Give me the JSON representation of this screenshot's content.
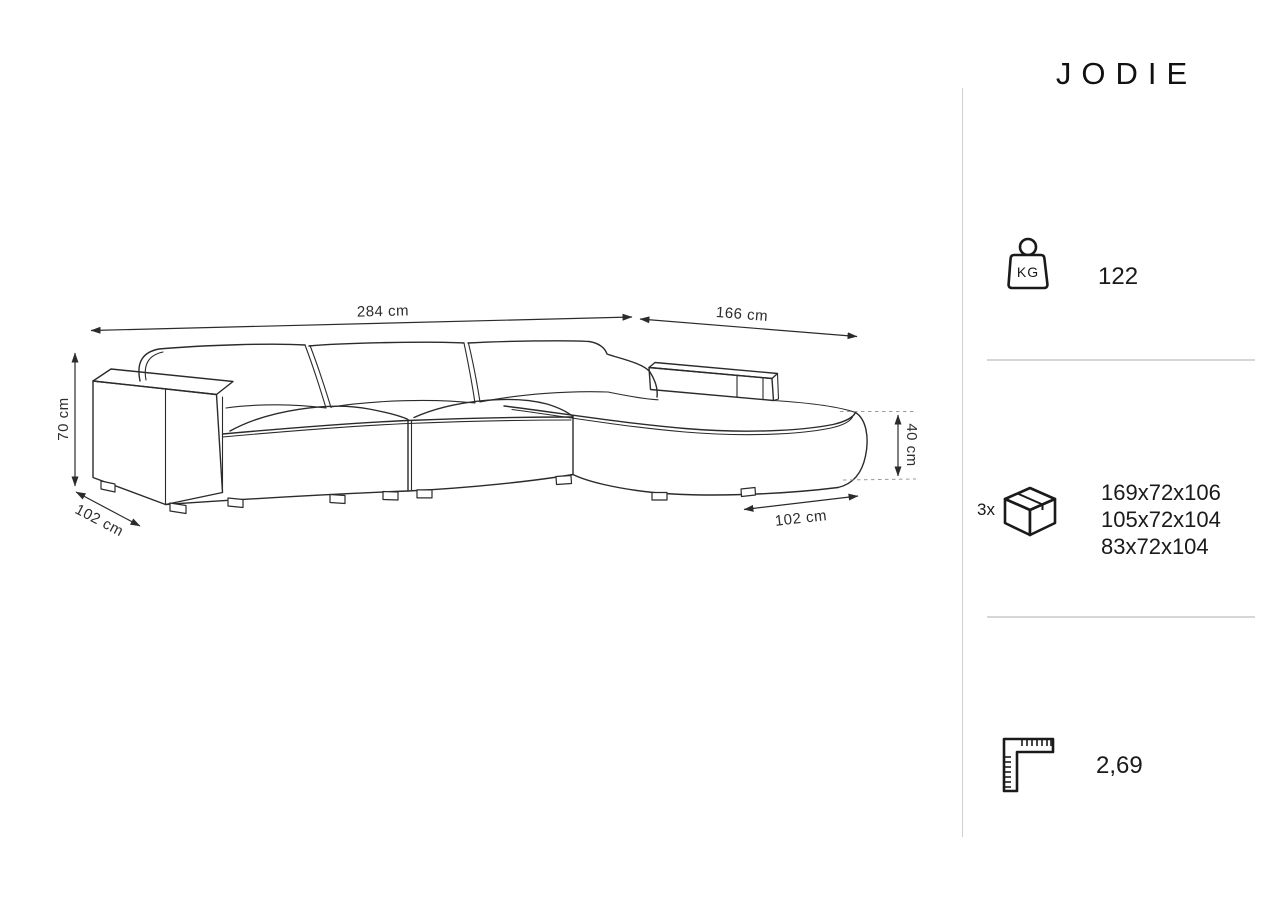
{
  "product": {
    "name": "JODIE"
  },
  "diagram": {
    "dimensions": {
      "total_width": "284 cm",
      "chaise_total_depth": "166 cm",
      "height": "70 cm",
      "depth_left": "102 cm",
      "seat_height": "40 cm",
      "chaise_width": "102 cm"
    }
  },
  "specs": {
    "weight": {
      "unit_label": "KG",
      "value": "122"
    },
    "packages": {
      "count_label": "3x",
      "sizes": [
        "169x72x106",
        "105x72x104",
        "83x72x104"
      ]
    },
    "volume": {
      "value": "2,69"
    }
  },
  "colors": {
    "line": "#2b2b2b",
    "divider": "#d6d6d6",
    "text": "#1a1a1a",
    "background": "#ffffff"
  }
}
